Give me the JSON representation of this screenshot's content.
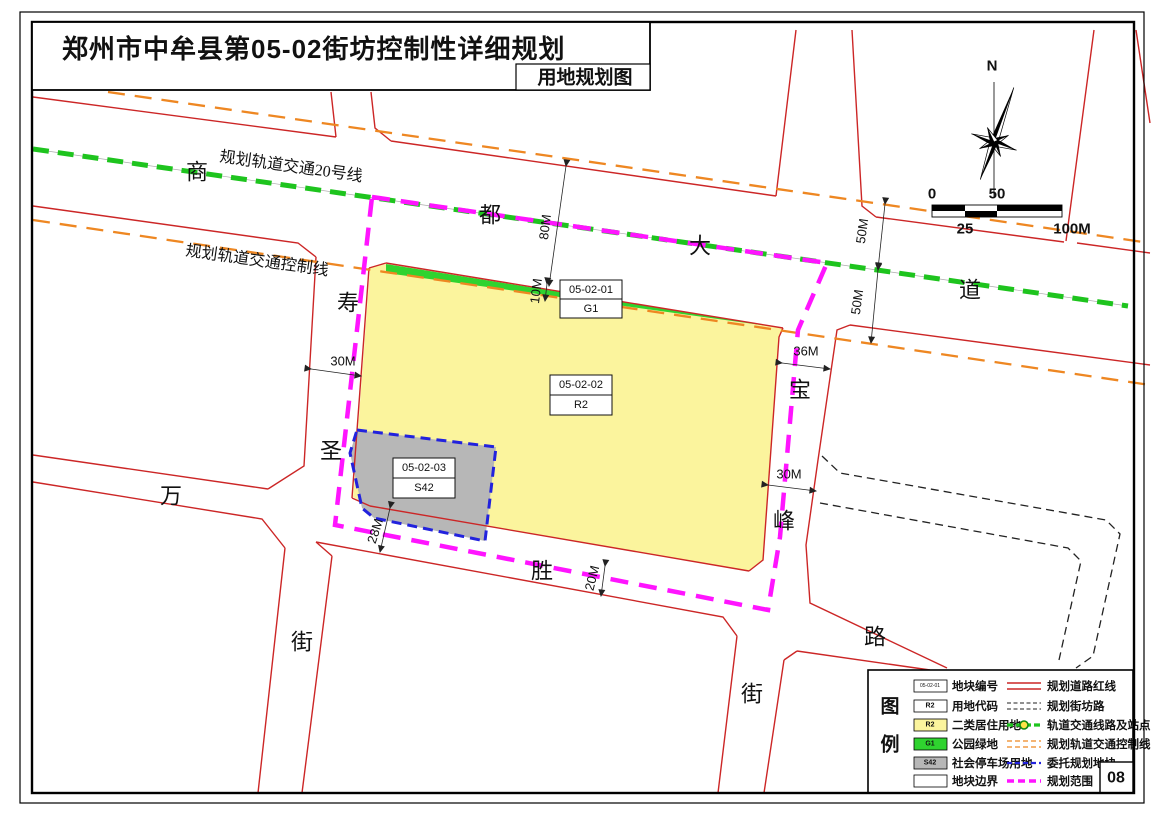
{
  "header": {
    "title": "郑州市中牟县第05-02街坊控制性详细规划",
    "subtitle": "用地规划图"
  },
  "page_number": "08",
  "compass_label": "N",
  "scalebar": {
    "l0": "0",
    "l25": "25",
    "l50": "50",
    "l100": "100M"
  },
  "rail": {
    "line_label": "规划轨道交通20号线",
    "control_label": "规划轨道交通控制线"
  },
  "road_names": {
    "shang": "商",
    "du": "都",
    "da": "大",
    "dao": "道",
    "shou": "寿",
    "sheng_sacred": "圣",
    "jie_left": "街",
    "wan": "万",
    "sheng_victory": "胜",
    "lu": "路",
    "bao": "宝",
    "feng": "峰",
    "jie_right": "街"
  },
  "dims": {
    "d80": "80M",
    "d10": "10M",
    "d50a": "50M",
    "d50b": "50M",
    "d36": "36M",
    "d30a": "30M",
    "d30b": "30M",
    "d28": "28M",
    "d20": "20M"
  },
  "parcels": {
    "g1": {
      "id": "05-02-01",
      "code": "G1"
    },
    "r2": {
      "id": "05-02-02",
      "code": "R2"
    },
    "s42": {
      "id": "05-02-03",
      "code": "S42"
    }
  },
  "legend": {
    "title_top": "图",
    "title_bottom": "例",
    "left": [
      {
        "swatch": "05-02-01",
        "label": "地块编号"
      },
      {
        "swatch": "R2",
        "label": "用地代码"
      },
      {
        "swatch": "R2",
        "label": "二类居住用地"
      },
      {
        "swatch": "G1",
        "label": "公园绿地"
      },
      {
        "swatch": "S42",
        "label": "社会停车场用地"
      },
      {
        "swatch": "",
        "label": "地块边界"
      }
    ],
    "right": [
      {
        "label": "规划道路红线"
      },
      {
        "label": "规划街坊路"
      },
      {
        "label": "轨道交通线路及站点"
      },
      {
        "label": "规划轨道交通控制线"
      },
      {
        "label": "委托规划地块"
      },
      {
        "label": "规划范围"
      }
    ]
  },
  "colors": {
    "road_red": "#cc2626",
    "rail_green": "#1ec41e",
    "control_orange": "#ee8722",
    "boundary_magenta": "#ff14ff",
    "delegate_blue": "#2222dd",
    "residential_yellow": "#fbf49d",
    "green_space": "#2fd32f",
    "parking_gray": "#b7b7b7"
  }
}
